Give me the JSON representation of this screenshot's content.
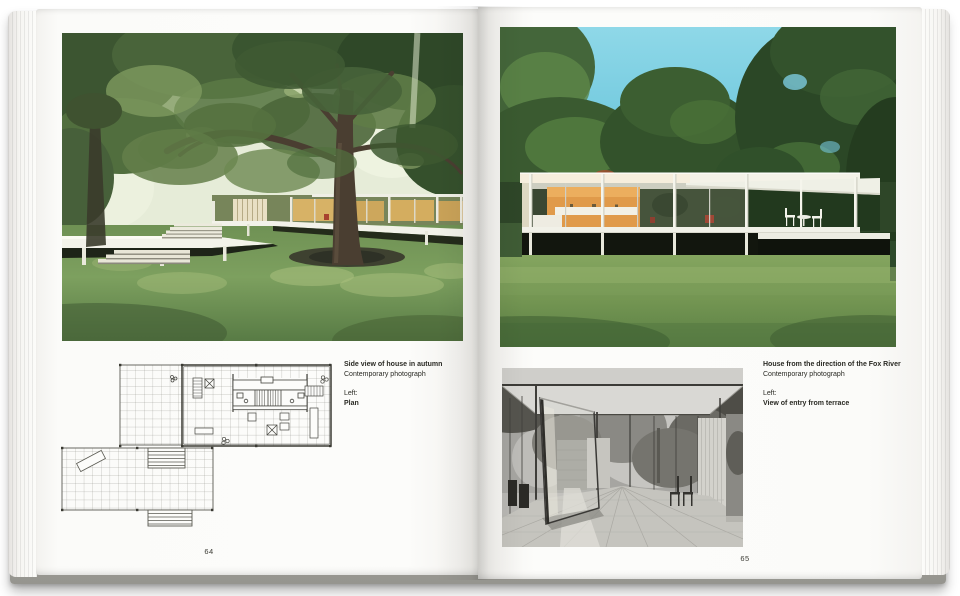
{
  "book": {
    "left_page": {
      "page_number": "64",
      "caption": {
        "title": "Side view of house in autumn",
        "credit": "Contemporary photograph",
        "ref_label": "Left:",
        "ref_title": "Plan"
      }
    },
    "right_page": {
      "page_number": "65",
      "caption": {
        "title": "House from the direction of the Fox River",
        "credit": "Contemporary photograph",
        "ref_label": "Left:",
        "ref_title": "View of entry from terrace"
      }
    },
    "colors": {
      "page_white": "#fbfbf9",
      "caption_text": "#2a2a24",
      "sky_blue": "#6cc9df",
      "grass_green": "#6f9150",
      "wood_core_orange": "#e09a4a",
      "foliage_green": "#3a5530"
    }
  }
}
